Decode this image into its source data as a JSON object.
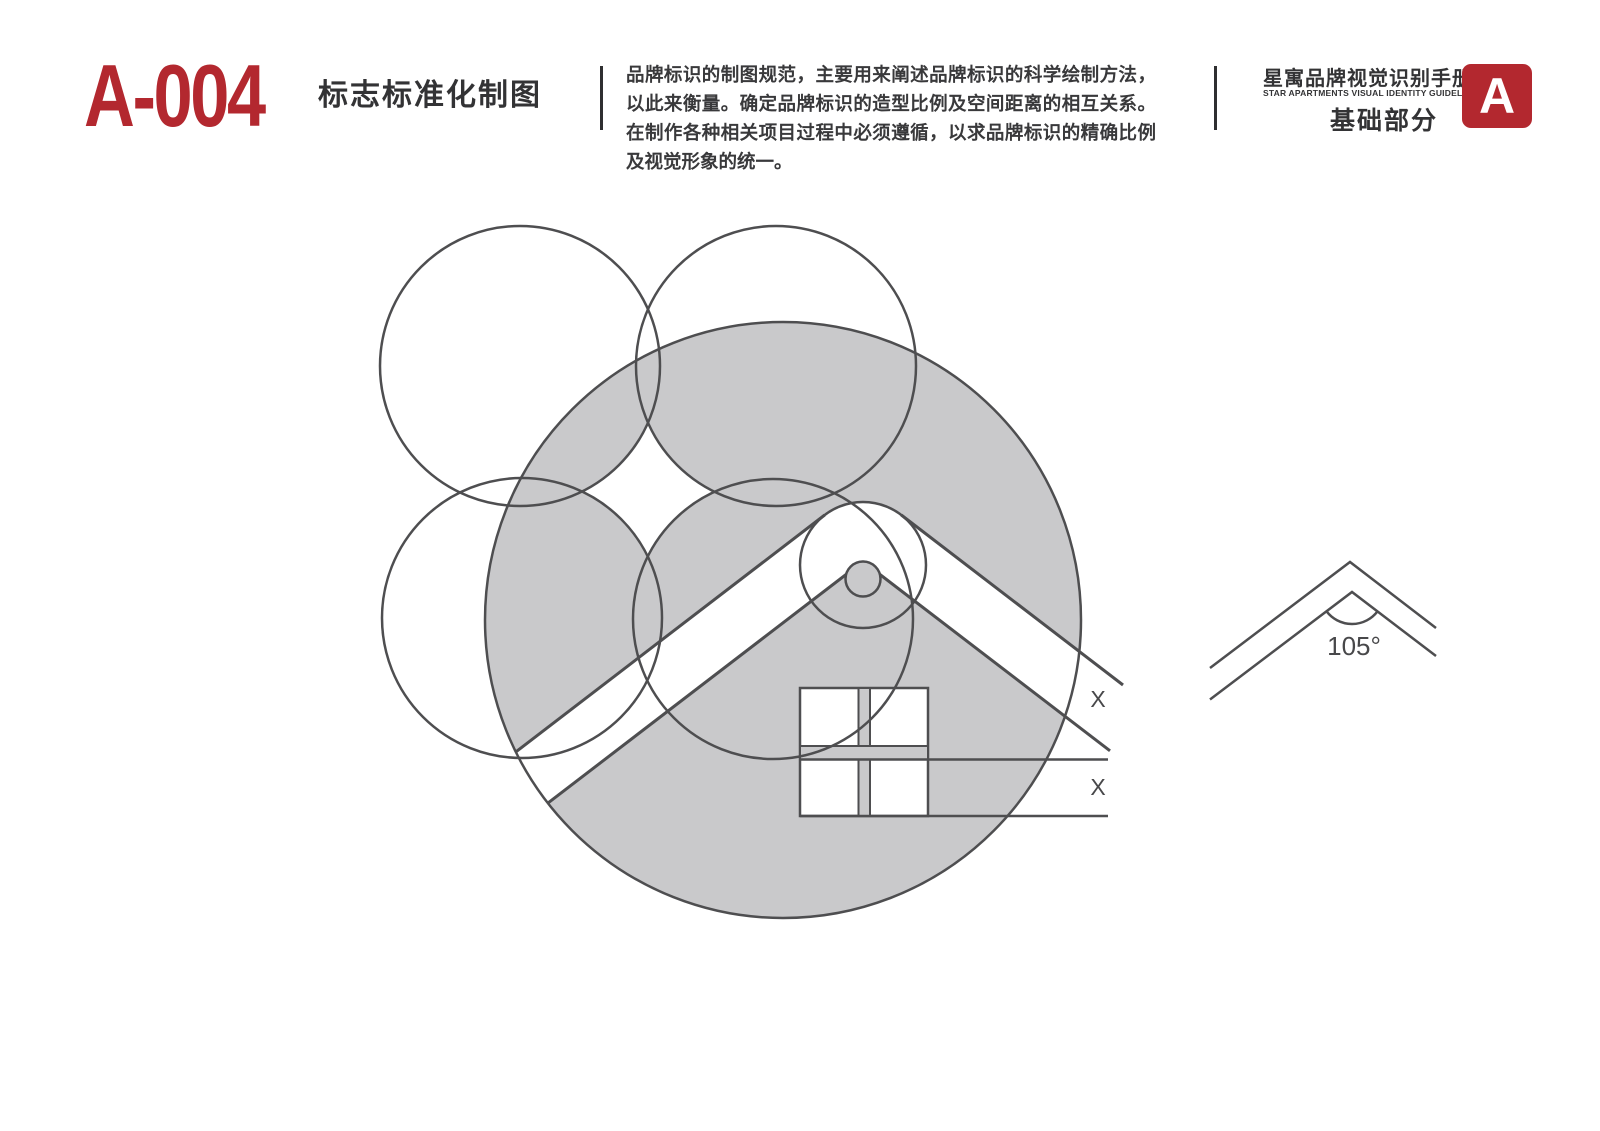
{
  "header": {
    "code": "A-004",
    "title": "标志标准化制图",
    "description": "品牌标识的制图规范，主要用来阐述品牌标识的科学绘制方法，以此来衡量。确定品牌标识的造型比例及空间距离的相互关系。在制作各种相关项目过程中必须遵循，以求品牌标识的精确比例及视觉形象的统一。",
    "manual_title_zh": "星寓品牌视觉识别手册",
    "manual_title_en": "STAR APARTMENTS VISUAL IDENTITY GUIDELINES",
    "section_label": "基础部分",
    "section_badge": "A"
  },
  "diagram": {
    "dimension_label_1": "X",
    "dimension_label_2": "X",
    "angle_label": "105°"
  },
  "colors": {
    "accent_red": "#b3282f",
    "fill_gray": "#c9c9cb",
    "line": "#4e4e50",
    "text_dark": "#373739"
  }
}
